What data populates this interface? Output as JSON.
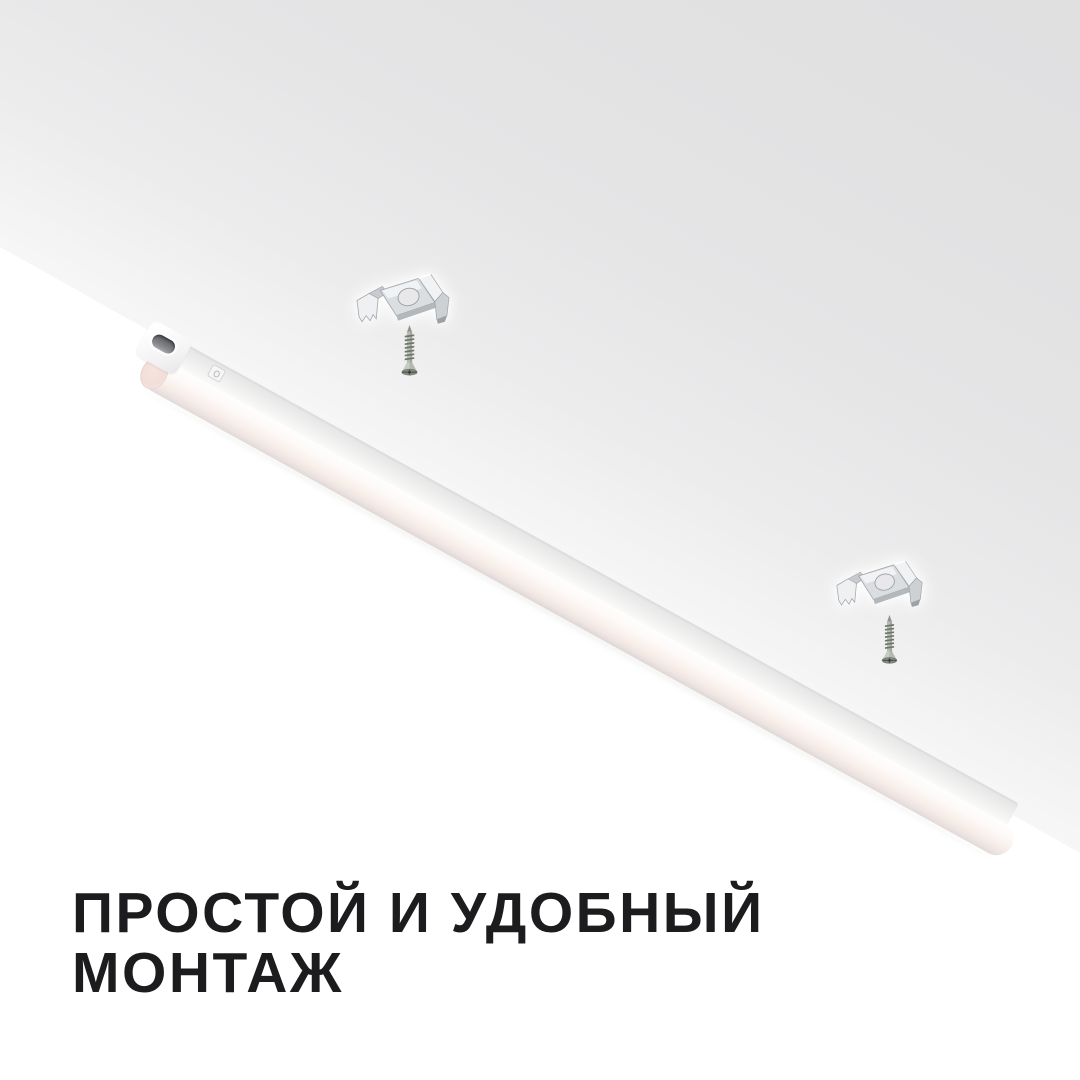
{
  "caption": {
    "line1": "ПРОСТОЙ И УДОБНЫЙ",
    "line2": "МОНТАЖ"
  },
  "scene": {
    "objects": {
      "fixture": "linear-led-batten-light",
      "mounting_clip_count": 2,
      "screw_count": 2
    }
  },
  "colors": {
    "background": "#ffffff",
    "ceiling_dark": "#e0e0e1",
    "ceiling_light": "#f7f7f8",
    "tube_tint": "#f9efeb",
    "metal_light": "#f1f2f3",
    "metal_dark": "#9da1a5",
    "socket_dark": "#595a5e",
    "text": "#1c1c1e"
  }
}
